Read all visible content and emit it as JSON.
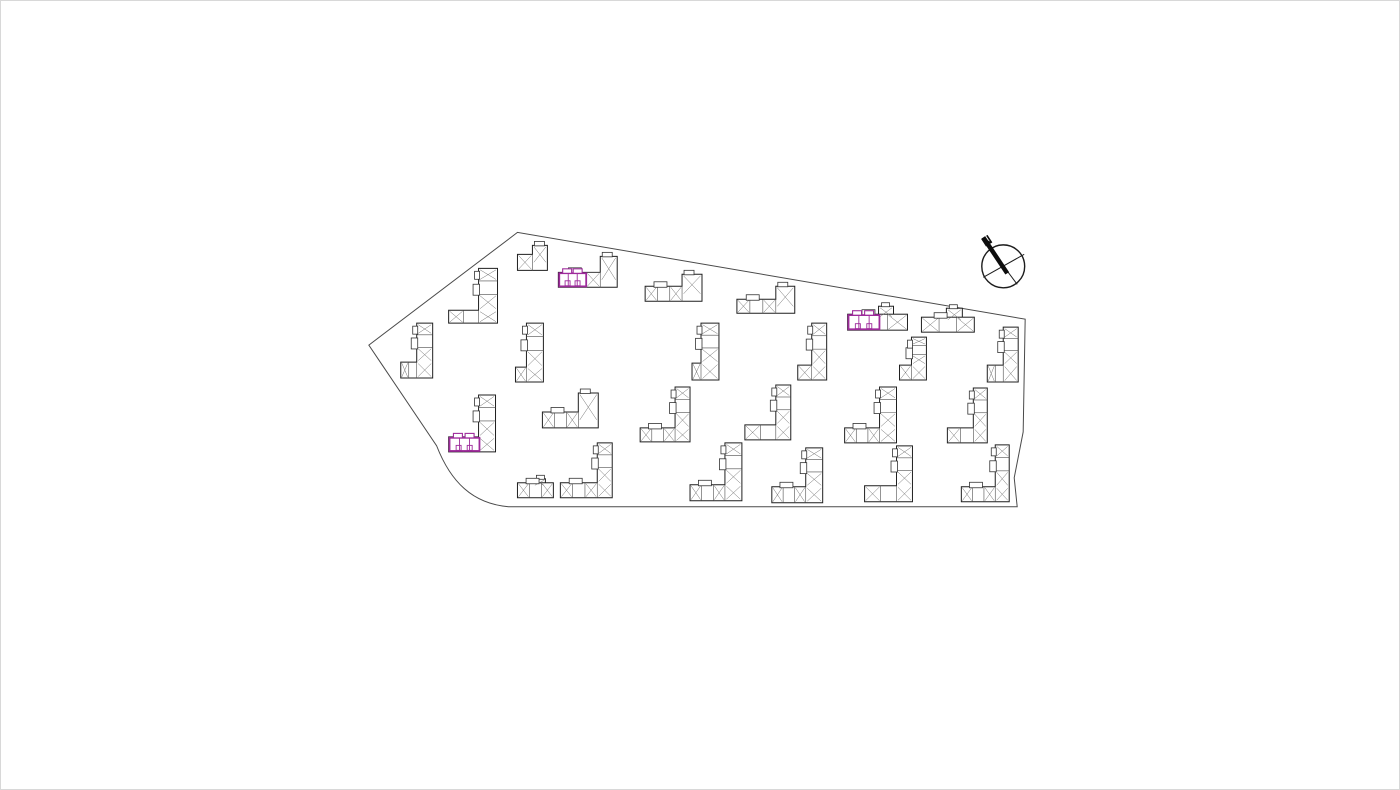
{
  "canvas": {
    "width": 1400,
    "height": 790
  },
  "colors": {
    "background": "#ffffff",
    "frame_border": "#d8d8d8",
    "ink": "#1f1f1f",
    "detail_line": "#4d4d4d",
    "boundary": "#4a4a4a",
    "highlight": "#9e2b9b"
  },
  "compass": {
    "label": "N"
  },
  "site": {
    "boundary_path": "M 368 345 L 517 232 L 1026 319 L 1024 432 L 1015 478 L 1018 507 L 508 507 C 472 504 450 482 436 446 Z"
  },
  "buildings": [
    {
      "id": "b01",
      "x": 517,
      "y": 245,
      "w": 30,
      "ww": 15,
      "wh": 9,
      "fh": 16
    },
    {
      "id": "b02",
      "x": 558,
      "y": 256,
      "w": 59,
      "ww": 17,
      "wh": 16,
      "fh": 15,
      "hl": true,
      "hlw": 27
    },
    {
      "id": "b03",
      "x": 645,
      "y": 274,
      "w": 57,
      "ww": 20,
      "wh": 12,
      "fh": 15
    },
    {
      "id": "b04",
      "x": 737,
      "y": 286,
      "w": 58,
      "ww": 19,
      "wh": 13,
      "fh": 14
    },
    {
      "id": "b05",
      "x": 848,
      "y": 306,
      "w": 60,
      "ww": 15,
      "wh": 8,
      "fh": 16,
      "inset": 14,
      "hl": true,
      "hlw": 31
    },
    {
      "id": "b06",
      "x": 922,
      "y": 308,
      "w": 53,
      "ww": 16,
      "wh": 9,
      "fh": 15,
      "inset": 12
    },
    {
      "id": "b07",
      "x": 400,
      "y": 323,
      "w": 32,
      "ww": 16,
      "wh": 39,
      "fh": 16
    },
    {
      "id": "b08",
      "x": 448,
      "y": 268,
      "w": 49,
      "ww": 19,
      "wh": 42,
      "fh": 13
    },
    {
      "id": "b09",
      "x": 515,
      "y": 323,
      "w": 28,
      "ww": 17,
      "wh": 44,
      "fh": 15
    },
    {
      "id": "b10",
      "x": 692,
      "y": 323,
      "w": 27,
      "ww": 18,
      "wh": 40,
      "fh": 17
    },
    {
      "id": "b11",
      "x": 798,
      "y": 323,
      "w": 29,
      "ww": 15,
      "wh": 42,
      "fh": 15
    },
    {
      "id": "b12",
      "x": 900,
      "y": 337,
      "w": 27,
      "ww": 15,
      "wh": 28,
      "fh": 15
    },
    {
      "id": "b13",
      "x": 988,
      "y": 327,
      "w": 31,
      "ww": 15,
      "wh": 38,
      "fh": 17
    },
    {
      "id": "b14",
      "x": 448,
      "y": 395,
      "w": 47,
      "ww": 17,
      "wh": 42,
      "fh": 15,
      "hl": true,
      "hlw": 30
    },
    {
      "id": "b15",
      "x": 542,
      "y": 393,
      "w": 56,
      "ww": 20,
      "wh": 19,
      "fh": 16
    },
    {
      "id": "b16",
      "x": 640,
      "y": 387,
      "w": 50,
      "ww": 15,
      "wh": 41,
      "fh": 14
    },
    {
      "id": "b17",
      "x": 745,
      "y": 385,
      "w": 46,
      "ww": 15,
      "wh": 40,
      "fh": 15
    },
    {
      "id": "b18",
      "x": 845,
      "y": 387,
      "w": 52,
      "ww": 17,
      "wh": 41,
      "fh": 15
    },
    {
      "id": "b19",
      "x": 948,
      "y": 388,
      "w": 40,
      "ww": 14,
      "wh": 40,
      "fh": 15
    },
    {
      "id": "b20",
      "x": 517,
      "y": 479,
      "w": 36,
      "ww": 12,
      "wh": 4,
      "fh": 15,
      "inset": 8
    },
    {
      "id": "b21",
      "x": 560,
      "y": 443,
      "w": 52,
      "ww": 15,
      "wh": 40,
      "fh": 15
    },
    {
      "id": "b22",
      "x": 690,
      "y": 443,
      "w": 52,
      "ww": 17,
      "wh": 42,
      "fh": 16
    },
    {
      "id": "b23",
      "x": 772,
      "y": 448,
      "w": 51,
      "ww": 17,
      "wh": 39,
      "fh": 16
    },
    {
      "id": "b24",
      "x": 865,
      "y": 446,
      "w": 48,
      "ww": 16,
      "wh": 40,
      "fh": 16
    },
    {
      "id": "b25",
      "x": 962,
      "y": 445,
      "w": 48,
      "ww": 14,
      "wh": 42,
      "fh": 15
    }
  ]
}
